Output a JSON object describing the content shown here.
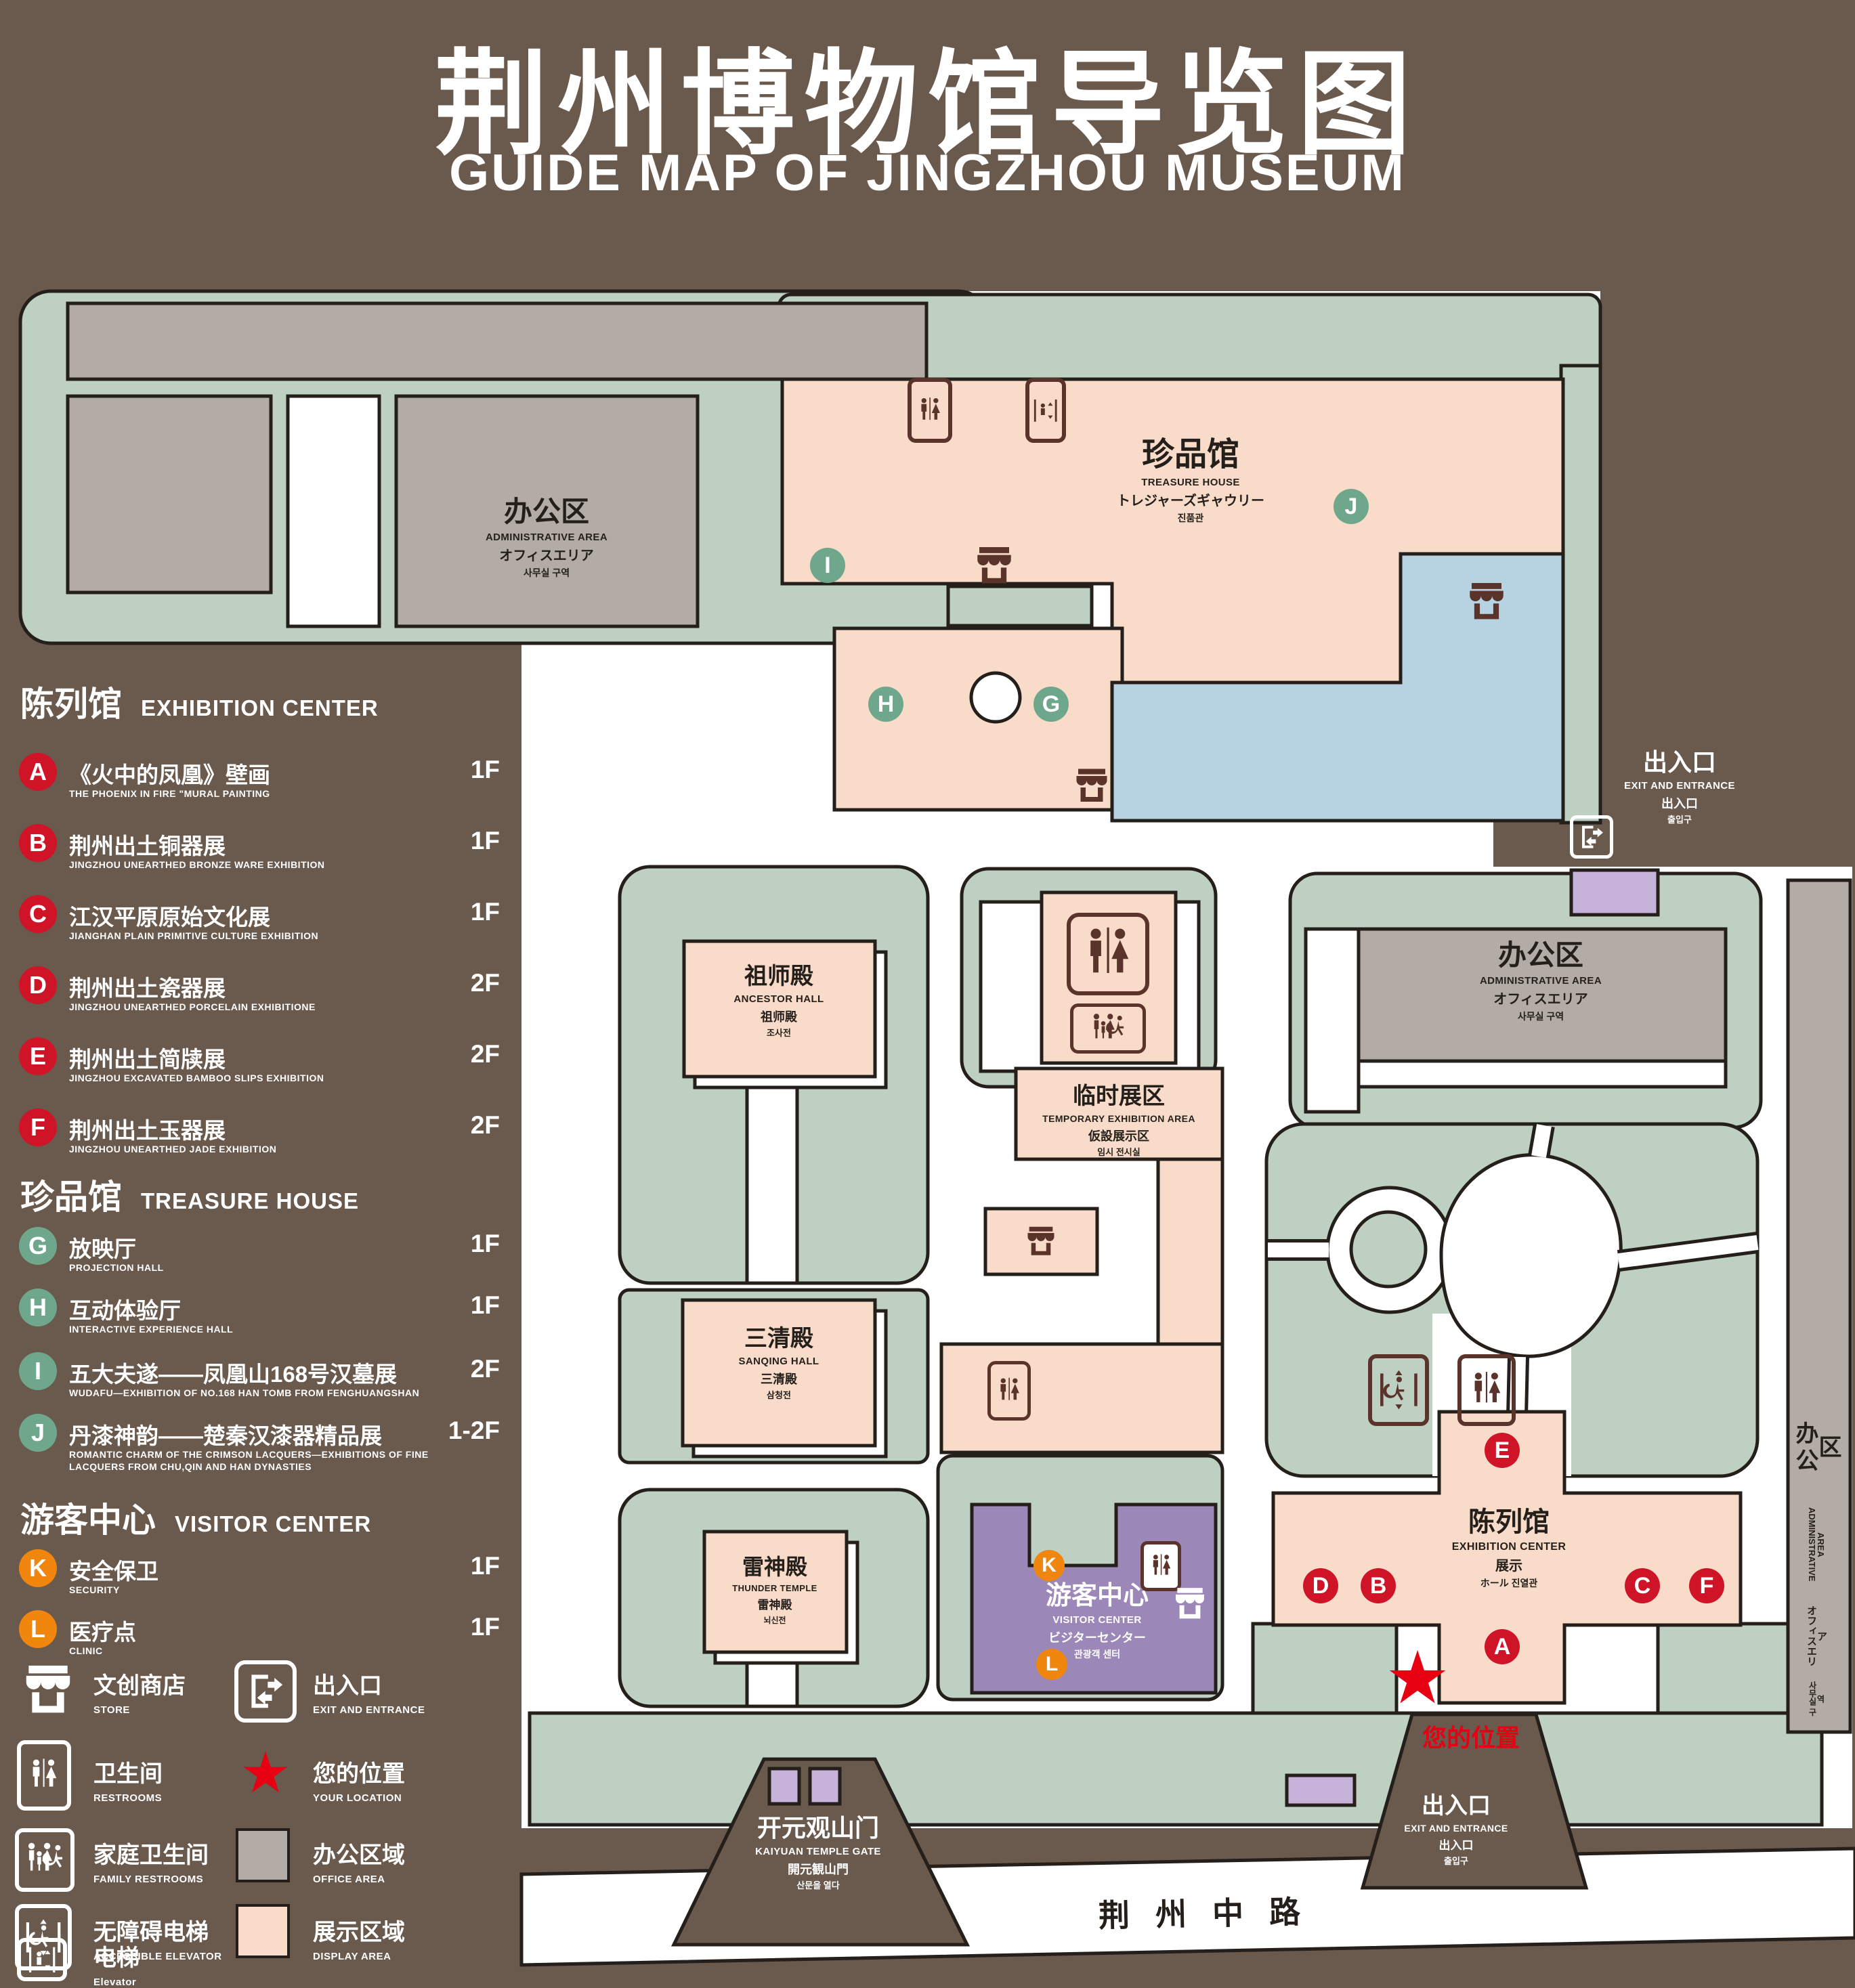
{
  "title": {
    "cjk": "荆州博物馆导览图",
    "en": "GUIDE MAP OF JINGZHOU MUSEUM"
  },
  "colors": {
    "background": "#6a594d",
    "campus_green": "#bdd0c2",
    "office_gray": "#b3aba5",
    "display_pink": "#f8dcc9",
    "lake_blue": "#b7d2e1",
    "visitor_purple": "#9c87b9",
    "gate_purple": "#c7b2da",
    "accent_red": "#e60012",
    "marker_red": "#cf1428",
    "marker_green": "#6fa78c",
    "marker_orange": "#f1860e",
    "icon_brown": "#5a332a"
  },
  "legend": {
    "sections": [
      {
        "cjk": "陈列馆",
        "en": "EXHIBITION CENTER"
      },
      {
        "cjk": "珍品馆",
        "en": "TREASURE HOUSE"
      },
      {
        "cjk": "游客中心",
        "en": "VISITOR CENTER"
      }
    ],
    "items": [
      {
        "letter": "A",
        "cjk": "《火中的凤凰》壁画",
        "en": "THE PHOENIX IN FIRE \"MURAL PAINTING",
        "floor": "1F"
      },
      {
        "letter": "B",
        "cjk": "荆州出土铜器展",
        "en": "JINGZHOU UNEARTHED BRONZE WARE EXHIBITION",
        "floor": "1F"
      },
      {
        "letter": "C",
        "cjk": "江汉平原原始文化展",
        "en": "JIANGHAN PLAIN PRIMITIVE CULTURE EXHIBITION",
        "floor": "1F"
      },
      {
        "letter": "D",
        "cjk": "荆州出土瓷器展",
        "en": "JINGZHOU UNEARTHED PORCELAIN EXHIBITIONE",
        "floor": "2F"
      },
      {
        "letter": "E",
        "cjk": "荆州出土简牍展",
        "en": "JINGZHOU EXCAVATED BAMBOO SLIPS EXHIBITION",
        "floor": "2F"
      },
      {
        "letter": "F",
        "cjk": "荆州出土玉器展",
        "en": "JINGZHOU UNEARTHED JADE EXHIBITION",
        "floor": "2F"
      },
      {
        "letter": "G",
        "cjk": "放映厅",
        "en": "PROJECTION HALL",
        "floor": "1F"
      },
      {
        "letter": "H",
        "cjk": "互动体验厅",
        "en": "INTERACTIVE EXPERIENCE HALL",
        "floor": "1F"
      },
      {
        "letter": "I",
        "cjk": "五大夫遂——凤凰山168号汉墓展",
        "en": "WUDAFU—EXHIBITION OF NO.168 HAN TOMB FROM FENGHUANGSHAN",
        "floor": "2F"
      },
      {
        "letter": "J",
        "cjk": "丹漆神韵——楚秦汉漆器精品展",
        "en": "ROMANTIC CHARM OF THE CRIMSON LACQUERS—EXHIBITIONS OF FINE LACQUERS FROM CHU,QIN AND HAN DYNASTIES",
        "floor": "1-2F"
      },
      {
        "letter": "K",
        "cjk": "安全保卫",
        "en": "SECURITY",
        "floor": "1F"
      },
      {
        "letter": "L",
        "cjk": "医疗点",
        "en": "CLINIC",
        "floor": "1F"
      }
    ],
    "symbols": [
      {
        "icon": "store-icon",
        "cjk": "文创商店",
        "en": "STORE"
      },
      {
        "icon": "restrooms-icon",
        "cjk": "卫生间",
        "en": "RESTROOMS"
      },
      {
        "icon": "family-restrooms-icon",
        "cjk": "家庭卫生间",
        "en": "FAMILY RESTROOMS"
      },
      {
        "icon": "accessible-elevator-icon",
        "cjk": "无障碍电梯",
        "en": "ACCESSIBLE  ELEVATOR"
      },
      {
        "icon": "elevator-icon",
        "cjk": "电梯",
        "en": "Elevator"
      },
      {
        "icon": "exit-entrance-icon",
        "cjk": "出入口",
        "en": "EXIT AND ENTRANCE"
      },
      {
        "icon": "your-location-star",
        "cjk": "您的位置",
        "en": "YOUR LOCATION"
      },
      {
        "icon": "office-area-swatch",
        "cjk": "办公区域",
        "en": "OFFICE AREA"
      },
      {
        "icon": "display-area-swatch",
        "cjk": "展示区域",
        "en": "DISPLAY AREA"
      }
    ]
  },
  "map": {
    "admin_nw": {
      "cjk": "办公区",
      "en": "ADMINISTRATIVE AREA",
      "jp": "オフィスエリア",
      "kr": "사무실 구역"
    },
    "admin_c": {
      "cjk": "办公区",
      "en": "ADMINISTRATIVE AREA",
      "jp": "オフィスエリア",
      "kr": "사무실 구역"
    },
    "admin_e": {
      "cjk": "办公区",
      "en": "ADMINISTRATIVE AREA",
      "jp": "オフィスエリア",
      "kr": "사무실 구역"
    },
    "treasure": {
      "cjk": "珍品馆",
      "en": "TREASURE HOUSE",
      "jp": "トレジャーズギャウリー",
      "kr": "진품관"
    },
    "ancestor": {
      "cjk": "祖师殿",
      "en": "ANCESTOR HALL",
      "jp": "祖师殿",
      "kr": "조사전"
    },
    "sanqing": {
      "cjk": "三清殿",
      "en": "SANQING HALL",
      "jp": "三清殿",
      "kr": "삼청전"
    },
    "thunder": {
      "cjk": "雷神殿",
      "en": "THUNDER TEMPLE",
      "jp": "雷神殿",
      "kr": "뇌신전"
    },
    "temporary": {
      "cjk": "临时展区",
      "en": "TEMPORARY EXHIBITION AREA",
      "jp": "仮設展示区",
      "kr": "임시 전시실"
    },
    "visitor": {
      "cjk": "游客中心",
      "en": "VISITOR CENTER",
      "jp": "ビジターセンター",
      "kr": "관광객 센터"
    },
    "exhibition": {
      "cjk": "陈列馆",
      "en": "EXHIBITION CENTER",
      "jp": "展示",
      "kr": "ホール  진열관"
    },
    "exit_ne": {
      "cjk": "出入口",
      "en": "EXIT AND ENTRANCE",
      "jp": "出入口",
      "kr": "출입구"
    },
    "exit_s": {
      "cjk": "出入口",
      "en": "EXIT AND ENTRANCE",
      "jp": "出入口",
      "kr": "출입구"
    },
    "gate": {
      "cjk": "开元观山门",
      "en": "KAIYUAN TEMPLE GATE",
      "jp": "開元観山門",
      "kr": "산문을 열다"
    },
    "road": "荆州中路",
    "your_location": "您的位置",
    "markers": {
      "A": "A",
      "B": "B",
      "C": "C",
      "D": "D",
      "E": "E",
      "F": "F",
      "G": "G",
      "H": "H",
      "I": "I",
      "J": "J",
      "K": "K",
      "L": "L"
    }
  }
}
